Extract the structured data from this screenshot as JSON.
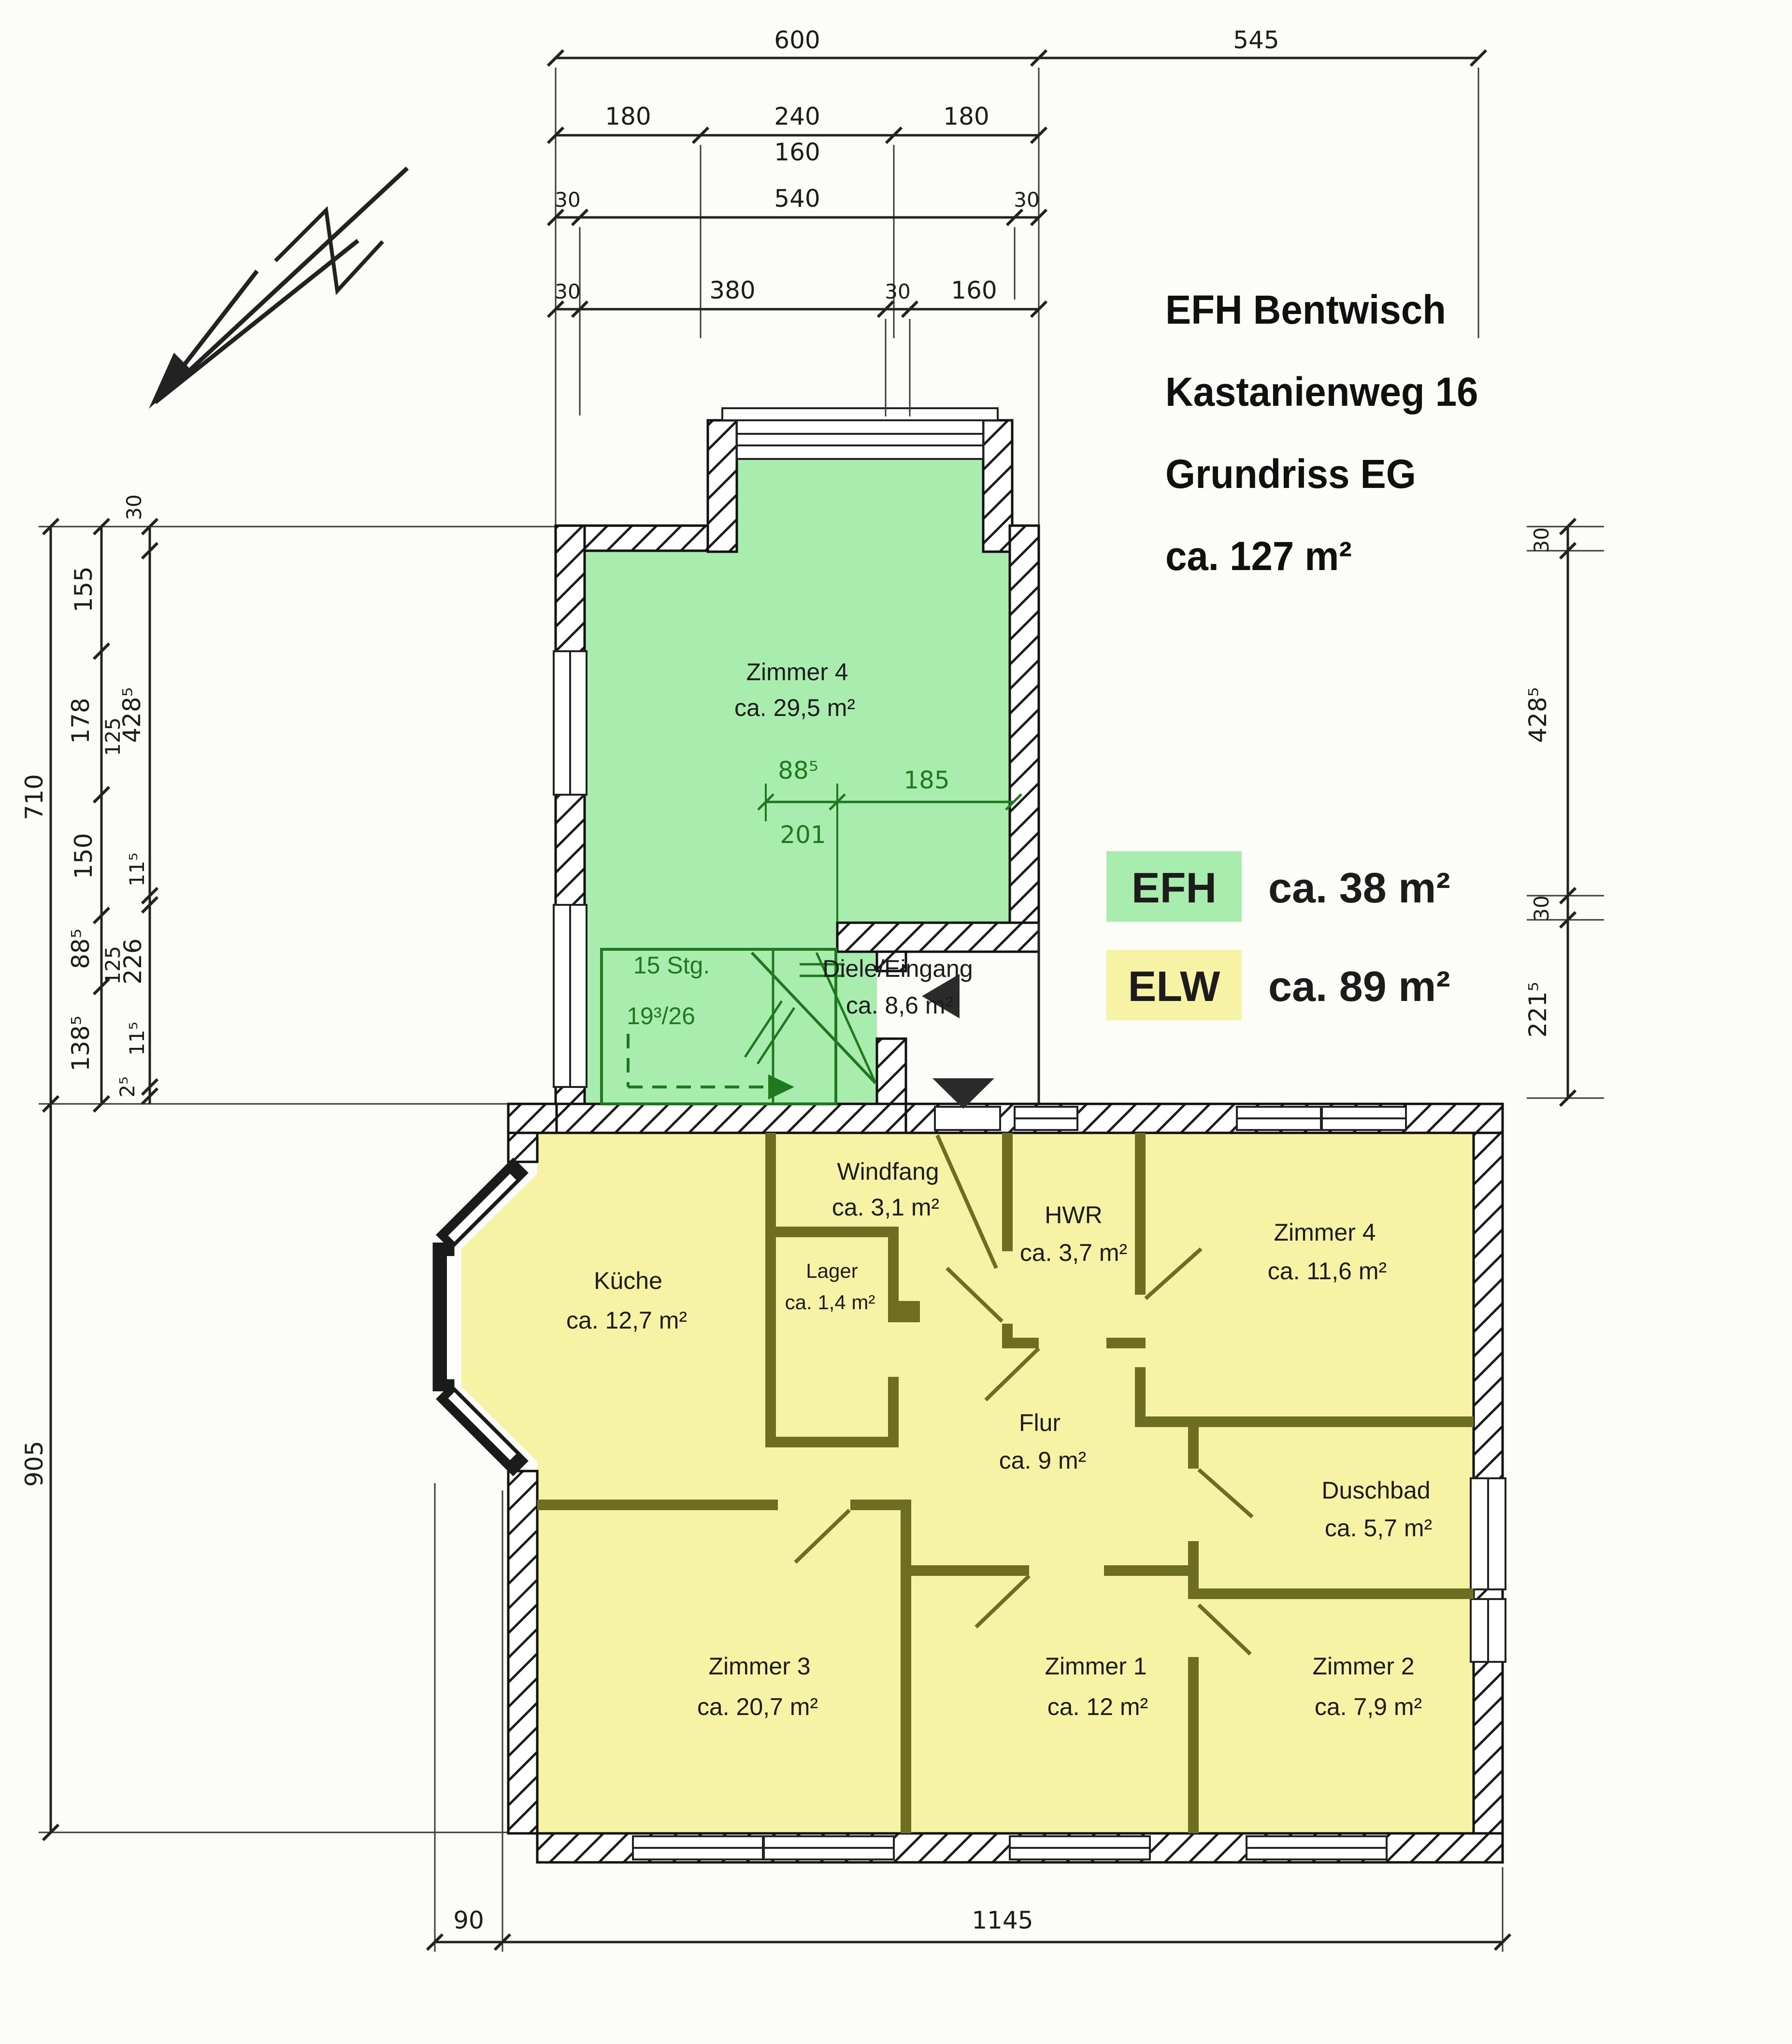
{
  "title": {
    "line1": "EFH Bentwisch",
    "line2": "Kastanienweg 16",
    "line3": "Grundriss EG",
    "line4": "ca. 127 m²"
  },
  "legend": {
    "efh_label": "EFH",
    "efh_area": "ca. 38 m²",
    "elw_label": "ELW",
    "elw_area": "ca. 89 m²",
    "efh_color": "#a9edae",
    "elw_color": "#f7f3a4"
  },
  "rooms": {
    "zimmer4_og": {
      "name": "Zimmer 4",
      "area": "ca. 29,5 m²"
    },
    "diele": {
      "name": "Diele/Eingang",
      "area": "ca. 8,6 m²"
    },
    "windfang": {
      "name": "Windfang",
      "area": "ca. 3,1 m²"
    },
    "hwr": {
      "name": "HWR",
      "area": "ca. 3,7 m²"
    },
    "zimmer4": {
      "name": "Zimmer 4",
      "area": "ca. 11,6 m²"
    },
    "kueche": {
      "name": "Küche",
      "area": "ca. 12,7 m²"
    },
    "lager": {
      "name": "Lager",
      "area": "ca. 1,4 m²"
    },
    "flur": {
      "name": "Flur",
      "area": "ca. 9 m²"
    },
    "duschbad": {
      "name": "Duschbad",
      "area": "ca. 5,7 m²"
    },
    "zimmer3": {
      "name": "Zimmer 3",
      "area": "ca. 20,7 m²"
    },
    "zimmer1": {
      "name": "Zimmer 1",
      "area": "ca. 12 m²"
    },
    "zimmer2": {
      "name": "Zimmer 2",
      "area": "ca. 7,9 m²"
    }
  },
  "stairs": {
    "label": "15 Stg.",
    "ratio": "19³/26"
  },
  "dims": {
    "top_row1": [
      "600",
      "545"
    ],
    "top_row2": [
      "180",
      "240",
      "180"
    ],
    "top_row2b": "160",
    "top_row3": [
      "30",
      "540",
      "30"
    ],
    "top_row4": [
      "30",
      "380",
      "30",
      "160"
    ],
    "left_outer": [
      "710",
      "905"
    ],
    "left_mid": [
      "155",
      "178",
      "125",
      "150",
      "88⁵",
      "125",
      "138⁵"
    ],
    "left_inner": [
      "30",
      "428⁵",
      "11⁵",
      "226",
      "11⁵",
      "2⁵"
    ],
    "right": [
      "30",
      "428⁵",
      "30",
      "221⁵"
    ],
    "bottom": [
      "90",
      "1145"
    ],
    "interior": [
      "88⁵",
      "201",
      "185"
    ]
  }
}
